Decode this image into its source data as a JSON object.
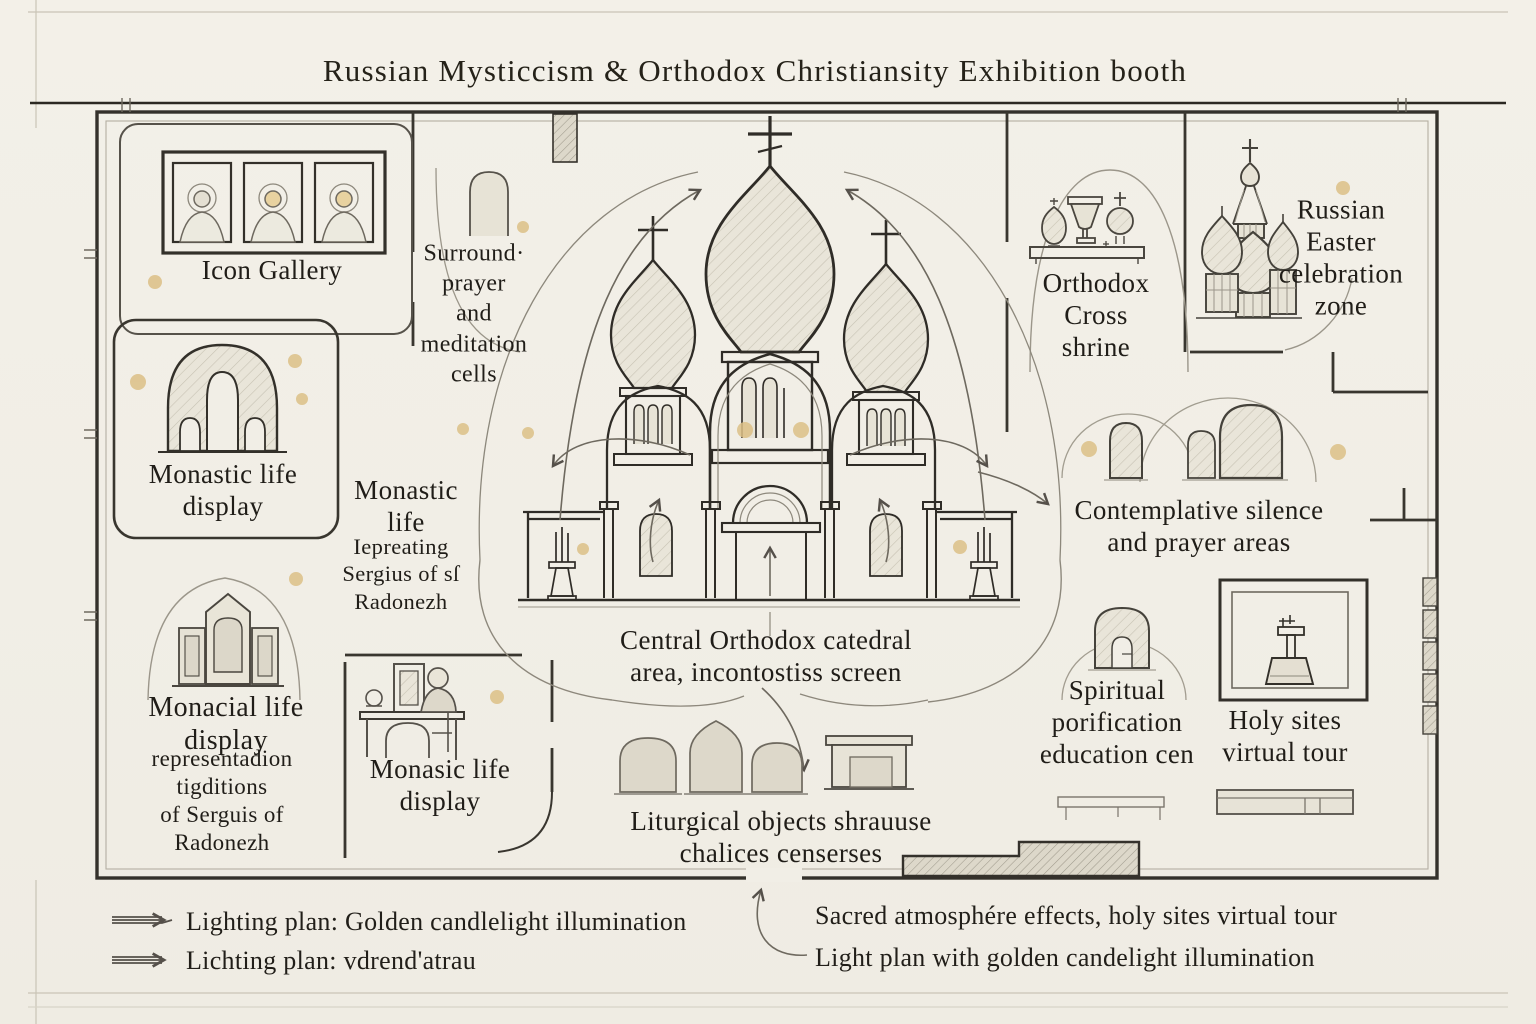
{
  "title": "Russian Mysticcism & Orthodox Christiansity Exhibition booth",
  "colors": {
    "paper": "#f1eee6",
    "ink": "#33302a",
    "sketch": "#8d887c",
    "gold": "#dcbf86"
  },
  "zones": {
    "icon_gallery": {
      "label": "Icon Gallery"
    },
    "surround_cells": {
      "label": "Surround·\nprayer\nand\nmeditation\ncells"
    },
    "monastic_life_display": {
      "label": "Monastic life\ndisplay"
    },
    "monastic_life_sergius": {
      "heading": "Monastic\nlife",
      "sub": "Iepreating\nSergius of  sſ\nRadonezh"
    },
    "monacial_life_display": {
      "heading": "Monacial life\ndisplay",
      "sub": "representadion\ntigditions\nof Serguis of\nRadonezh"
    },
    "monasic_life_display": {
      "label": "Monasic life\ndisplay"
    },
    "central_cathedral": {
      "label": "Central Orthodox catedral\narea, incontostiss screen"
    },
    "liturgical_objects": {
      "label": "Liturgical objects  shrauuse\nchalices censerses"
    },
    "orthodox_cross_shrine": {
      "label": "Orthodox\nCross\nshrine"
    },
    "russian_easter_zone": {
      "label": "Russian\nEaster\ncelebration\nzone"
    },
    "contemplative_areas": {
      "label": "Contemplative  silence\nand prayer areas"
    },
    "spiritual_education": {
      "label": "Spiritual\nporification\neducation cen"
    },
    "holy_sites_tour": {
      "label": "Holy sites\nvirtual tour"
    }
  },
  "legend": {
    "lighting_1": "Lighting plan: Golden candlelight illumination",
    "lighting_2": "Lichting plan: vdrend'atrau",
    "atmosphere_1": "Sacred atmosphére effects, holy sites virtual tour",
    "atmosphere_2": "Light plan with golden candelight illumination"
  },
  "icons": {
    "icon_gallery": "triple-icon-frames-icon",
    "monastic": "arched-window-icon",
    "monacial": "triptych-shrine-icon",
    "monasic": "monk-at-desk-icon",
    "cathedral": "orthodox-cathedral-icon",
    "shrine": "chalice-shelf-icon",
    "easter": "st-basil-towers-icon",
    "contemplative": "prayer-niche-icon",
    "spiritual": "education-niche-icon",
    "holy_sites": "virtual-tour-kiosk-icon",
    "liturgical": "display-niches-icon",
    "candles": "golden-candlelight-dot-icon",
    "flow": "visitor-flow-arrow-icon"
  }
}
